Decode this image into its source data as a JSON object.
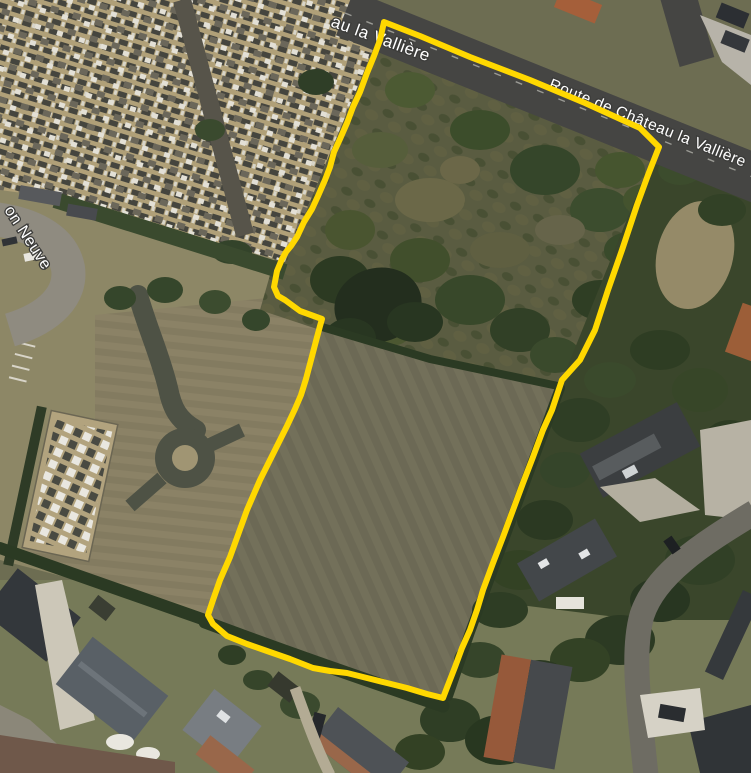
{
  "map": {
    "view_type": "satellite",
    "labels": {
      "road_fragment_top": "au la Vallière",
      "road_main": "Route de Château la Vallière",
      "road_left_fragment": "on Neuve"
    },
    "parcel_outline": {
      "color": "#ffd800",
      "stroke_width": 6,
      "points": [
        [
          384,
          22
        ],
        [
          420,
          36
        ],
        [
          470,
          57
        ],
        [
          530,
          80
        ],
        [
          585,
          103
        ],
        [
          640,
          128
        ],
        [
          659,
          147
        ],
        [
          648,
          175
        ],
        [
          637,
          205
        ],
        [
          622,
          250
        ],
        [
          608,
          290
        ],
        [
          595,
          330
        ],
        [
          580,
          360
        ],
        [
          562,
          380
        ],
        [
          552,
          410
        ],
        [
          543,
          430
        ],
        [
          533,
          457
        ],
        [
          523,
          483
        ],
        [
          513,
          510
        ],
        [
          503,
          537
        ],
        [
          493,
          563
        ],
        [
          483,
          590
        ],
        [
          477,
          610
        ],
        [
          470,
          630
        ],
        [
          462,
          648
        ],
        [
          455,
          667
        ],
        [
          448,
          685
        ],
        [
          443,
          698
        ],
        [
          427,
          694
        ],
        [
          407,
          688
        ],
        [
          387,
          683
        ],
        [
          367,
          678
        ],
        [
          347,
          673
        ],
        [
          330,
          671
        ],
        [
          313,
          668
        ],
        [
          290,
          659
        ],
        [
          267,
          651
        ],
        [
          247,
          644
        ],
        [
          227,
          636
        ],
        [
          213,
          624
        ],
        [
          208,
          615
        ],
        [
          213,
          600
        ],
        [
          220,
          580
        ],
        [
          230,
          557
        ],
        [
          247,
          510
        ],
        [
          260,
          480
        ],
        [
          270,
          460
        ],
        [
          278,
          444
        ],
        [
          287,
          426
        ],
        [
          295,
          409
        ],
        [
          301,
          395
        ],
        [
          306,
          379
        ],
        [
          311,
          360
        ],
        [
          316,
          341
        ],
        [
          320,
          326
        ],
        [
          322,
          319
        ],
        [
          300,
          311
        ],
        [
          285,
          300
        ],
        [
          278,
          296
        ],
        [
          274,
          287
        ],
        [
          277,
          271
        ],
        [
          282,
          259
        ],
        [
          286,
          252
        ],
        [
          291,
          246
        ],
        [
          297,
          237
        ],
        [
          304,
          222
        ],
        [
          312,
          209
        ],
        [
          318,
          196
        ],
        [
          325,
          180
        ],
        [
          330,
          167
        ],
        [
          334,
          152
        ],
        [
          340,
          139
        ],
        [
          347,
          123
        ],
        [
          353,
          107
        ],
        [
          360,
          92
        ],
        [
          367,
          73
        ],
        [
          374,
          56
        ],
        [
          380,
          40
        ],
        [
          384,
          22
        ]
      ]
    },
    "colors": {
      "road": "#454543",
      "cemetery_ground": "#b0a078",
      "field": "#73705a",
      "trees_dark": "#2c3a23",
      "label_text": "#ffffff"
    }
  }
}
